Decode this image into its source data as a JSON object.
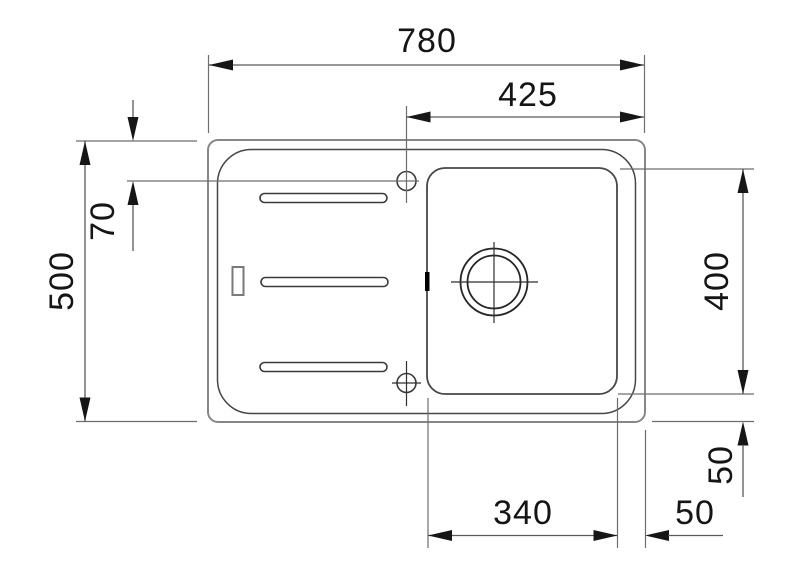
{
  "drawing": {
    "unit": "mm",
    "colors": {
      "background": "#ffffff",
      "outline_gray": "#878787",
      "linework_dark": "#474747",
      "dimension_lines": "#5a5a5a",
      "text_and_arrows": "#151515"
    },
    "dimensions": {
      "overall_width": "780",
      "faucet_to_right_edge": "425",
      "overall_depth": "500",
      "faucet_from_top_edge": "70",
      "bowl_depth": "400",
      "bowl_width": "340",
      "bowl_to_bottom_edge": "50",
      "bowl_to_right_edge": "50"
    }
  }
}
